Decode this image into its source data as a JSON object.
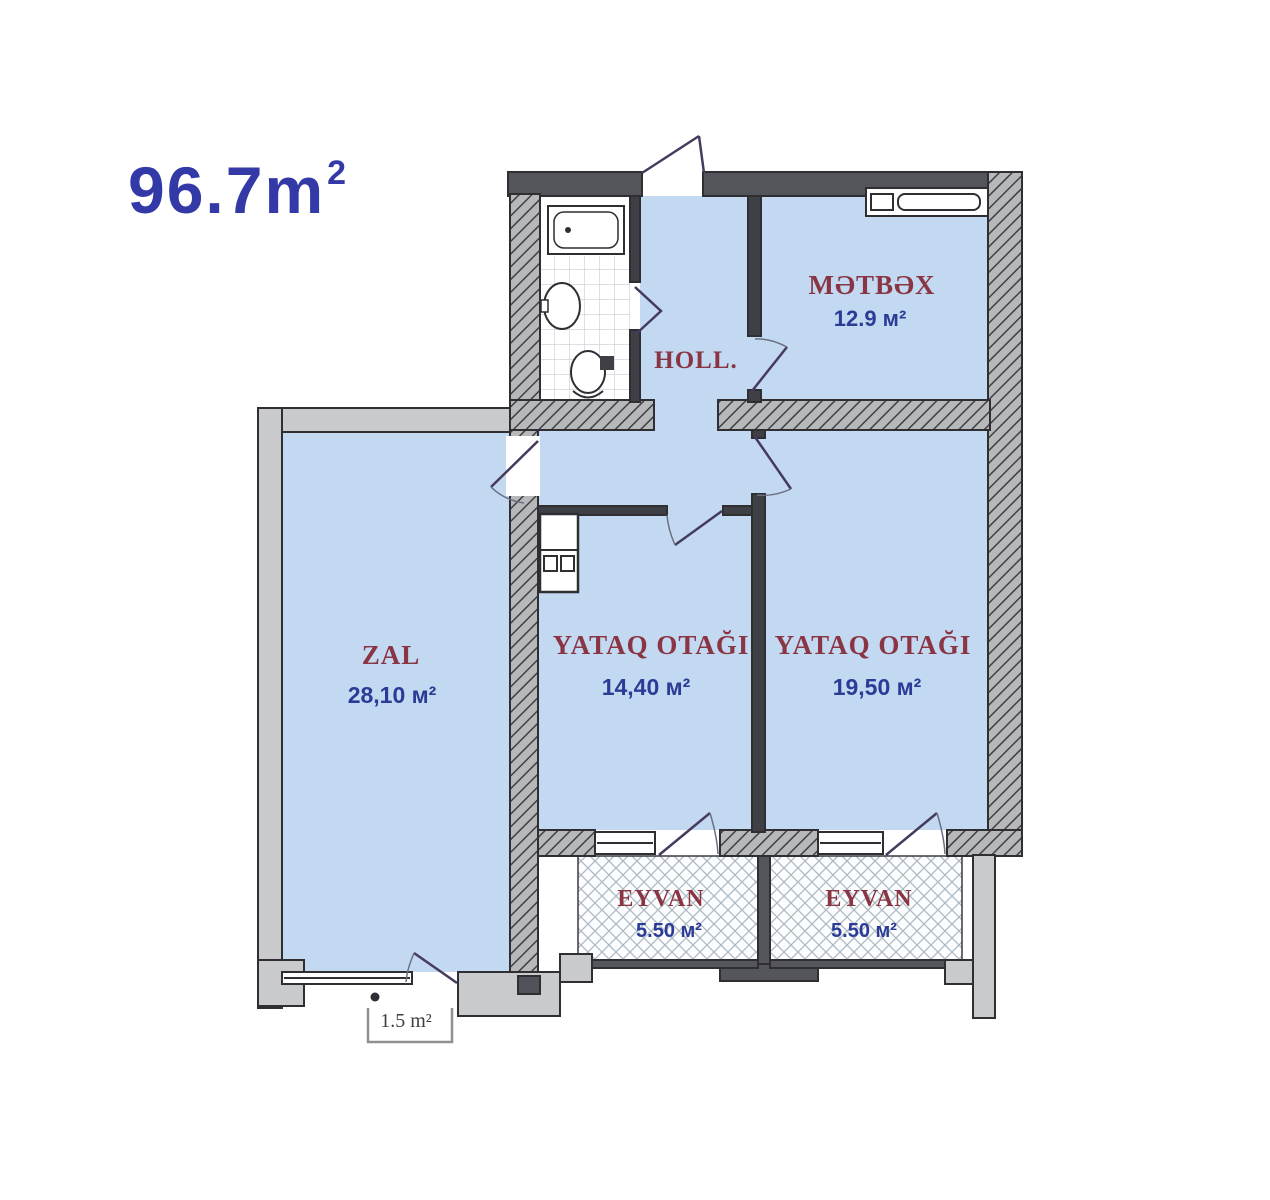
{
  "title": {
    "value": "96.7",
    "unit": "m",
    "sup": "2"
  },
  "plan": {
    "colors": {
      "room_fill": "#c2d9f1",
      "wall_dark": "#54555b",
      "wall_light": "#c9cacc",
      "hatch_wall_bg": "#b7b8ba",
      "room_name": "#8a3544",
      "area_value": "#2c3c96",
      "title": "#3439a8",
      "door_leaf": "#473a5f"
    },
    "rooms": [
      {
        "key": "metbex",
        "name": "MƏTBƏX",
        "area": "12.9 м²"
      },
      {
        "key": "holl",
        "name": "HOLL.",
        "area": ""
      },
      {
        "key": "zal",
        "name": "ZAL",
        "area": "28,10 м²"
      },
      {
        "key": "yataq-otagi-1",
        "name": "YATAQ OTAĞI",
        "area": "14,40 м²"
      },
      {
        "key": "yataq-otagi-2",
        "name": "YATAQ OTAĞI",
        "area": "19,50 м²"
      },
      {
        "key": "eyvan-1",
        "name": "EYVAN",
        "area": "5.50 м²"
      },
      {
        "key": "eyvan-2",
        "name": "EYVAN",
        "area": "5.50 м²"
      },
      {
        "key": "kicik-balkon",
        "name": "",
        "area": "1.5 m²"
      }
    ]
  }
}
